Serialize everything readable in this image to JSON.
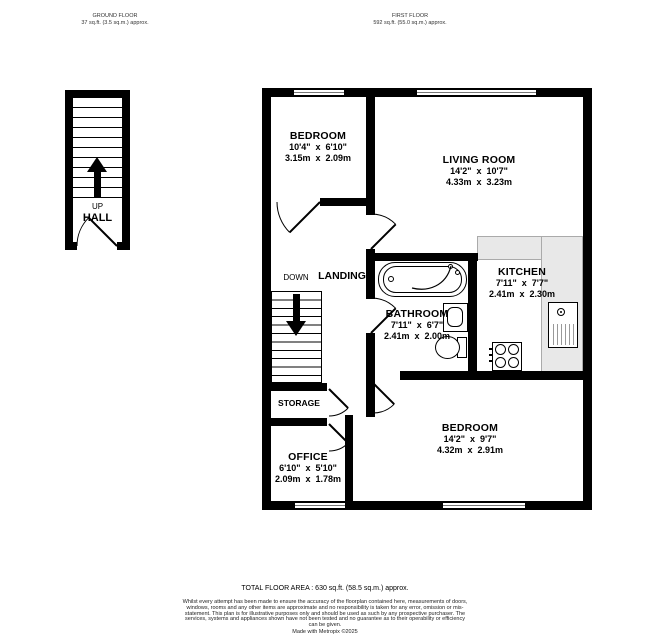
{
  "headers": {
    "ground": {
      "title": "GROUND FLOOR",
      "area": "37 sq.ft. (3.5 sq.m.) approx."
    },
    "first": {
      "title": "FIRST FLOOR",
      "area": "592 sq.ft. (55.0 sq.m.) approx."
    }
  },
  "ground_floor": {
    "hall_label": "HALL",
    "up_label": "UP"
  },
  "first_floor": {
    "bedroom1": {
      "name": "BEDROOM",
      "imperial": "10'4\"  x  6'10\"",
      "metric": "3.15m  x  2.09m"
    },
    "living_room": {
      "name": "LIVING ROOM",
      "imperial": "14'2\"  x  10'7\"",
      "metric": "4.33m  x  3.23m"
    },
    "kitchen": {
      "name": "KITCHEN",
      "imperial": "7'11\"  x  7'7\"",
      "metric": "2.41m  x  2.30m"
    },
    "bathroom": {
      "name": "BATHROOM",
      "imperial": "7'11\"  x  6'7\"",
      "metric": "2.41m  x  2.00m"
    },
    "bedroom2": {
      "name": "BEDROOM",
      "imperial": "14'2\"  x  9'7\"",
      "metric": "4.32m  x  2.91m"
    },
    "office": {
      "name": "OFFICE",
      "imperial": "6'10\"  x  5'10\"",
      "metric": "2.09m  x  1.78m"
    },
    "landing_label": "LANDING",
    "down_label": "DOWN",
    "storage_label": "STORAGE"
  },
  "footer": {
    "total_area": "TOTAL FLOOR AREA : 630 sq.ft. (58.5 sq.m.) approx.",
    "disclaimer": "Whilst every attempt has been made to ensure the accuracy of the floorplan contained here, measurements of doors, windows, rooms and any other items are approximate and no responsibility is taken for any error, omission or mis-statement. This plan is for illustrative purposes only and should be used as such by any prospective purchaser. The services, systems and appliances shown have not been tested and no guarantee as to their operability or efficiency can be given.",
    "credit": "Made with Metropix ©2025"
  },
  "colors": {
    "wall": "#000000",
    "counter": "#e8e8e8",
    "background": "#ffffff"
  }
}
